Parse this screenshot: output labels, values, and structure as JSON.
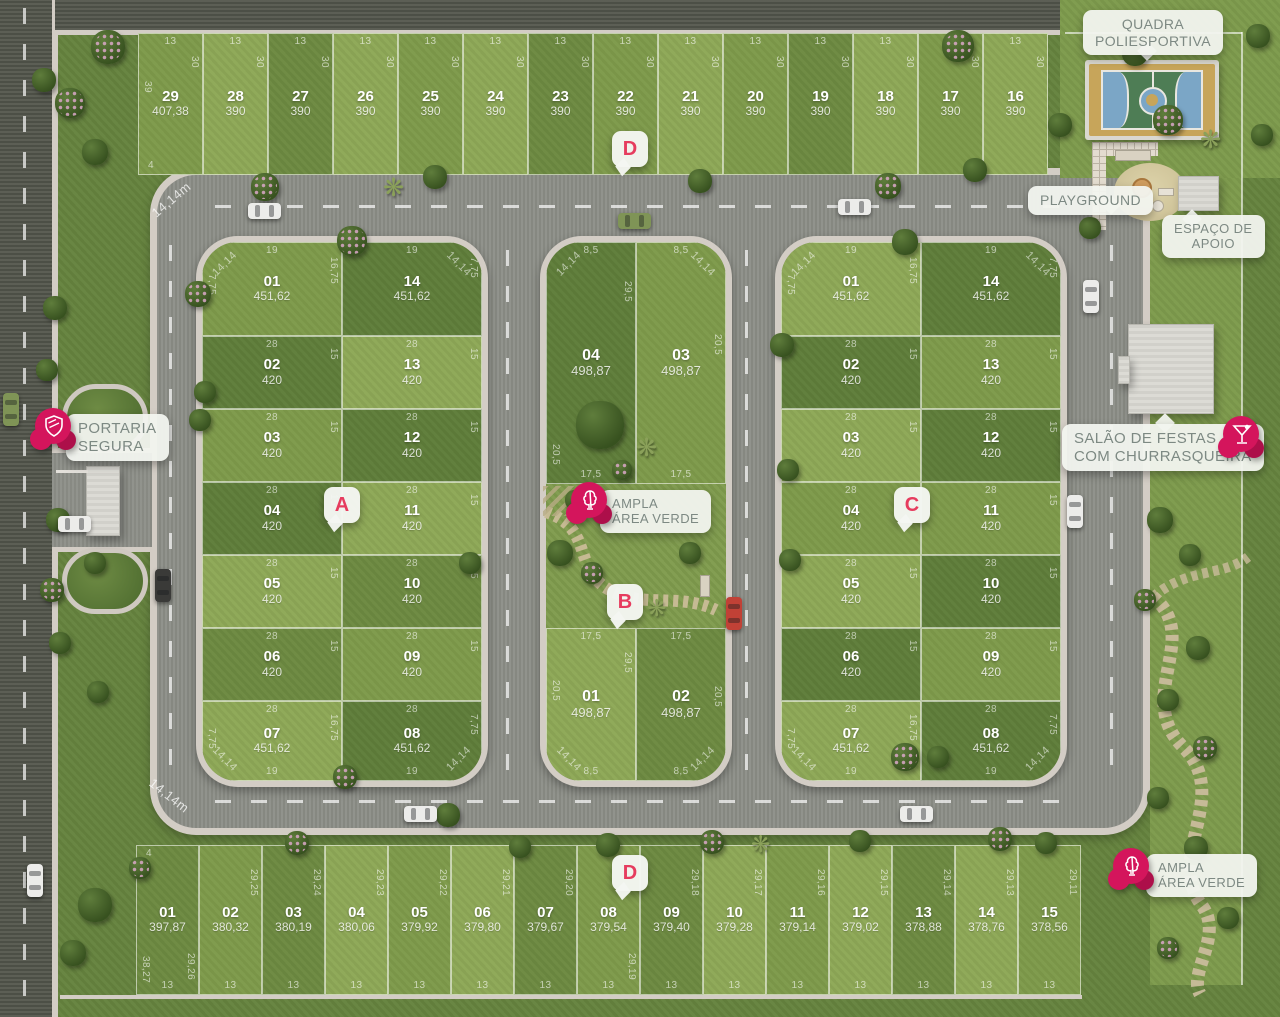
{
  "site": {
    "badges": {
      "top": "D",
      "block_a": "A",
      "block_b": "B",
      "block_c": "C",
      "bottom": "D"
    },
    "labels": {
      "quadra_poliesportiva": [
        "QUADRA",
        "POLIESPORTIVA"
      ],
      "playground": "PLAYGROUND",
      "espaco_apoio": [
        "ESPAÇO DE",
        "APOIO"
      ],
      "portaria": [
        "PORTARIA",
        "SEGURA"
      ],
      "salao_festas": [
        "SALÃO DE FESTAS",
        "COM CHURRASQUEIRA"
      ],
      "area_verde_central": [
        "AMPLA",
        "ÁREA VERDE"
      ],
      "area_verde_sudeste": [
        "AMPLA",
        "ÁREA VERDE"
      ]
    },
    "road_dims": {
      "top_left": "14,14m",
      "bottom_left": "14,14m"
    },
    "colors": {
      "accent_pink": "#d4155c",
      "accent_pink_dark": "#ad0f4a",
      "badge_letter": "#e63c5e",
      "road": "#8d8f88",
      "sidewalk": "#d3cdc5",
      "label_text": "#7d8983"
    }
  },
  "quadras": {
    "top_row": {
      "lots": [
        {
          "num": "29",
          "area": "407,38",
          "dims": {
            "top": "13",
            "side": "30",
            "outer": "39",
            "bottom": "4"
          }
        },
        {
          "num": "28",
          "area": "390",
          "dims": {
            "top": "13",
            "side": "30"
          }
        },
        {
          "num": "27",
          "area": "390",
          "dims": {
            "top": "13",
            "side": "30"
          }
        },
        {
          "num": "26",
          "area": "390",
          "dims": {
            "top": "13",
            "side": "30"
          }
        },
        {
          "num": "25",
          "area": "390",
          "dims": {
            "top": "13",
            "side": "30"
          }
        },
        {
          "num": "24",
          "area": "390",
          "dims": {
            "top": "13",
            "side": "30"
          }
        },
        {
          "num": "23",
          "area": "390",
          "dims": {
            "top": "13",
            "side": "30"
          }
        },
        {
          "num": "22",
          "area": "390",
          "dims": {
            "top": "13",
            "side": "30"
          }
        },
        {
          "num": "21",
          "area": "390",
          "dims": {
            "top": "13",
            "side": "30"
          }
        },
        {
          "num": "20",
          "area": "390",
          "dims": {
            "top": "13",
            "side": "30"
          }
        },
        {
          "num": "19",
          "area": "390",
          "dims": {
            "top": "13",
            "side": "30"
          }
        },
        {
          "num": "18",
          "area": "390",
          "dims": {
            "top": "13",
            "side": "30"
          }
        },
        {
          "num": "17",
          "area": "390",
          "dims": {
            "top": "13",
            "side": "30"
          }
        },
        {
          "num": "16",
          "area": "390",
          "dims": {
            "top": "13",
            "side": "30"
          }
        }
      ]
    },
    "block_a": {
      "corner_dim": "14,14",
      "left_col": [
        {
          "num": "01",
          "area": "451,62",
          "dims": {
            "top": "19",
            "side": "16,75",
            "outer": "7,75"
          }
        },
        {
          "num": "02",
          "area": "420",
          "dims": {
            "top": "28",
            "side": "15"
          }
        },
        {
          "num": "03",
          "area": "420",
          "dims": {
            "top": "28",
            "side": "15"
          }
        },
        {
          "num": "04",
          "area": "420",
          "dims": {
            "top": "28",
            "side": "15"
          }
        },
        {
          "num": "05",
          "area": "420",
          "dims": {
            "top": "28",
            "side": "15"
          }
        },
        {
          "num": "06",
          "area": "420",
          "dims": {
            "top": "28",
            "side": "15"
          }
        },
        {
          "num": "07",
          "area": "451,62",
          "dims": {
            "top": "28",
            "side": "16,75",
            "outer": "7,75",
            "bottom": "19"
          }
        }
      ],
      "right_col": [
        {
          "num": "14",
          "area": "451,62",
          "dims": {
            "top": "19",
            "side": "7,75"
          }
        },
        {
          "num": "13",
          "area": "420",
          "dims": {
            "top": "28",
            "side": "15"
          }
        },
        {
          "num": "12",
          "area": "420",
          "dims": {
            "top": "28",
            "side": "15"
          }
        },
        {
          "num": "11",
          "area": "420",
          "dims": {
            "top": "28",
            "side": "15"
          }
        },
        {
          "num": "10",
          "area": "420",
          "dims": {
            "top": "28",
            "side": "15"
          }
        },
        {
          "num": "09",
          "area": "420",
          "dims": {
            "top": "28",
            "side": "15"
          }
        },
        {
          "num": "08",
          "area": "451,62",
          "dims": {
            "top": "28",
            "side": "7,75",
            "bottom": "19"
          }
        }
      ]
    },
    "block_b": {
      "corner_dim": "14,14",
      "top_pair": [
        {
          "num": "04",
          "area": "498,87",
          "dims": {
            "top": "8,5",
            "side": "29,5",
            "outer": "20,5",
            "bottom": "17,5"
          }
        },
        {
          "num": "03",
          "area": "498,87",
          "dims": {
            "top": "8,5",
            "side": "20,5",
            "bottom": "17,5"
          }
        }
      ],
      "bottom_pair": [
        {
          "num": "01",
          "area": "498,87",
          "dims": {
            "top": "17,5",
            "side": "29,5",
            "outer": "20,5",
            "bottom": "8,5"
          }
        },
        {
          "num": "02",
          "area": "498,87",
          "dims": {
            "top": "17,5",
            "side": "20,5",
            "bottom": "8,5"
          }
        }
      ]
    },
    "block_c": {
      "corner_dim": "14,14",
      "left_col": [
        {
          "num": "01",
          "area": "451,62",
          "dims": {
            "top": "19",
            "side": "16,75",
            "outer": "7,75"
          }
        },
        {
          "num": "02",
          "area": "420",
          "dims": {
            "top": "28",
            "side": "15"
          }
        },
        {
          "num": "03",
          "area": "420",
          "dims": {
            "top": "28",
            "side": "15"
          }
        },
        {
          "num": "04",
          "area": "420",
          "dims": {
            "top": "28",
            "side": "15"
          }
        },
        {
          "num": "05",
          "area": "420",
          "dims": {
            "top": "28",
            "side": "15"
          }
        },
        {
          "num": "06",
          "area": "420",
          "dims": {
            "top": "28",
            "side": "15"
          }
        },
        {
          "num": "07",
          "area": "451,62",
          "dims": {
            "top": "28",
            "side": "16,75",
            "outer": "7,75",
            "bottom": "19"
          }
        }
      ],
      "right_col": [
        {
          "num": "14",
          "area": "451,62",
          "dims": {
            "top": "19",
            "side": "7,75"
          }
        },
        {
          "num": "13",
          "area": "420",
          "dims": {
            "top": "28",
            "side": "15"
          }
        },
        {
          "num": "12",
          "area": "420",
          "dims": {
            "top": "28",
            "side": "15"
          }
        },
        {
          "num": "11",
          "area": "420",
          "dims": {
            "top": "28",
            "side": "15"
          }
        },
        {
          "num": "10",
          "area": "420",
          "dims": {
            "top": "28",
            "side": "15"
          }
        },
        {
          "num": "09",
          "area": "420",
          "dims": {
            "top": "28",
            "side": "15"
          }
        },
        {
          "num": "08",
          "area": "451,62",
          "dims": {
            "top": "28",
            "side": "7,75",
            "bottom": "19"
          }
        }
      ]
    },
    "bottom_row": {
      "lots": [
        {
          "num": "01",
          "area": "397,87",
          "dims": {
            "top": "4",
            "side": "29,26",
            "outer": "38,27",
            "bottom": "13"
          }
        },
        {
          "num": "02",
          "area": "380,32",
          "dims": {
            "side": "29,25",
            "bottom": "13"
          }
        },
        {
          "num": "03",
          "area": "380,19",
          "dims": {
            "side": "29,24",
            "bottom": "13"
          }
        },
        {
          "num": "04",
          "area": "380,06",
          "dims": {
            "side": "29,23",
            "bottom": "13"
          }
        },
        {
          "num": "05",
          "area": "379,92",
          "dims": {
            "side": "29,22",
            "bottom": "13"
          }
        },
        {
          "num": "06",
          "area": "379,80",
          "dims": {
            "side": "29,21",
            "bottom": "13"
          }
        },
        {
          "num": "07",
          "area": "379,67",
          "dims": {
            "side": "29,20",
            "bottom": "13"
          }
        },
        {
          "num": "08",
          "area": "379,54",
          "dims": {
            "side": "29,19",
            "bottom": "13"
          }
        },
        {
          "num": "09",
          "area": "379,40",
          "dims": {
            "side": "29,18",
            "bottom": "13"
          }
        },
        {
          "num": "10",
          "area": "379,28",
          "dims": {
            "side": "29,17",
            "bottom": "13"
          }
        },
        {
          "num": "11",
          "area": "379,14",
          "dims": {
            "side": "29,16",
            "bottom": "13"
          }
        },
        {
          "num": "12",
          "area": "379,02",
          "dims": {
            "side": "29,15",
            "bottom": "13"
          }
        },
        {
          "num": "13",
          "area": "378,88",
          "dims": {
            "side": "29,14",
            "bottom": "13"
          }
        },
        {
          "num": "14",
          "area": "378,76",
          "dims": {
            "side": "29,13",
            "bottom": "13"
          }
        },
        {
          "num": "15",
          "area": "378,56",
          "dims": {
            "side": "29,11",
            "bottom": "13"
          }
        }
      ]
    }
  }
}
